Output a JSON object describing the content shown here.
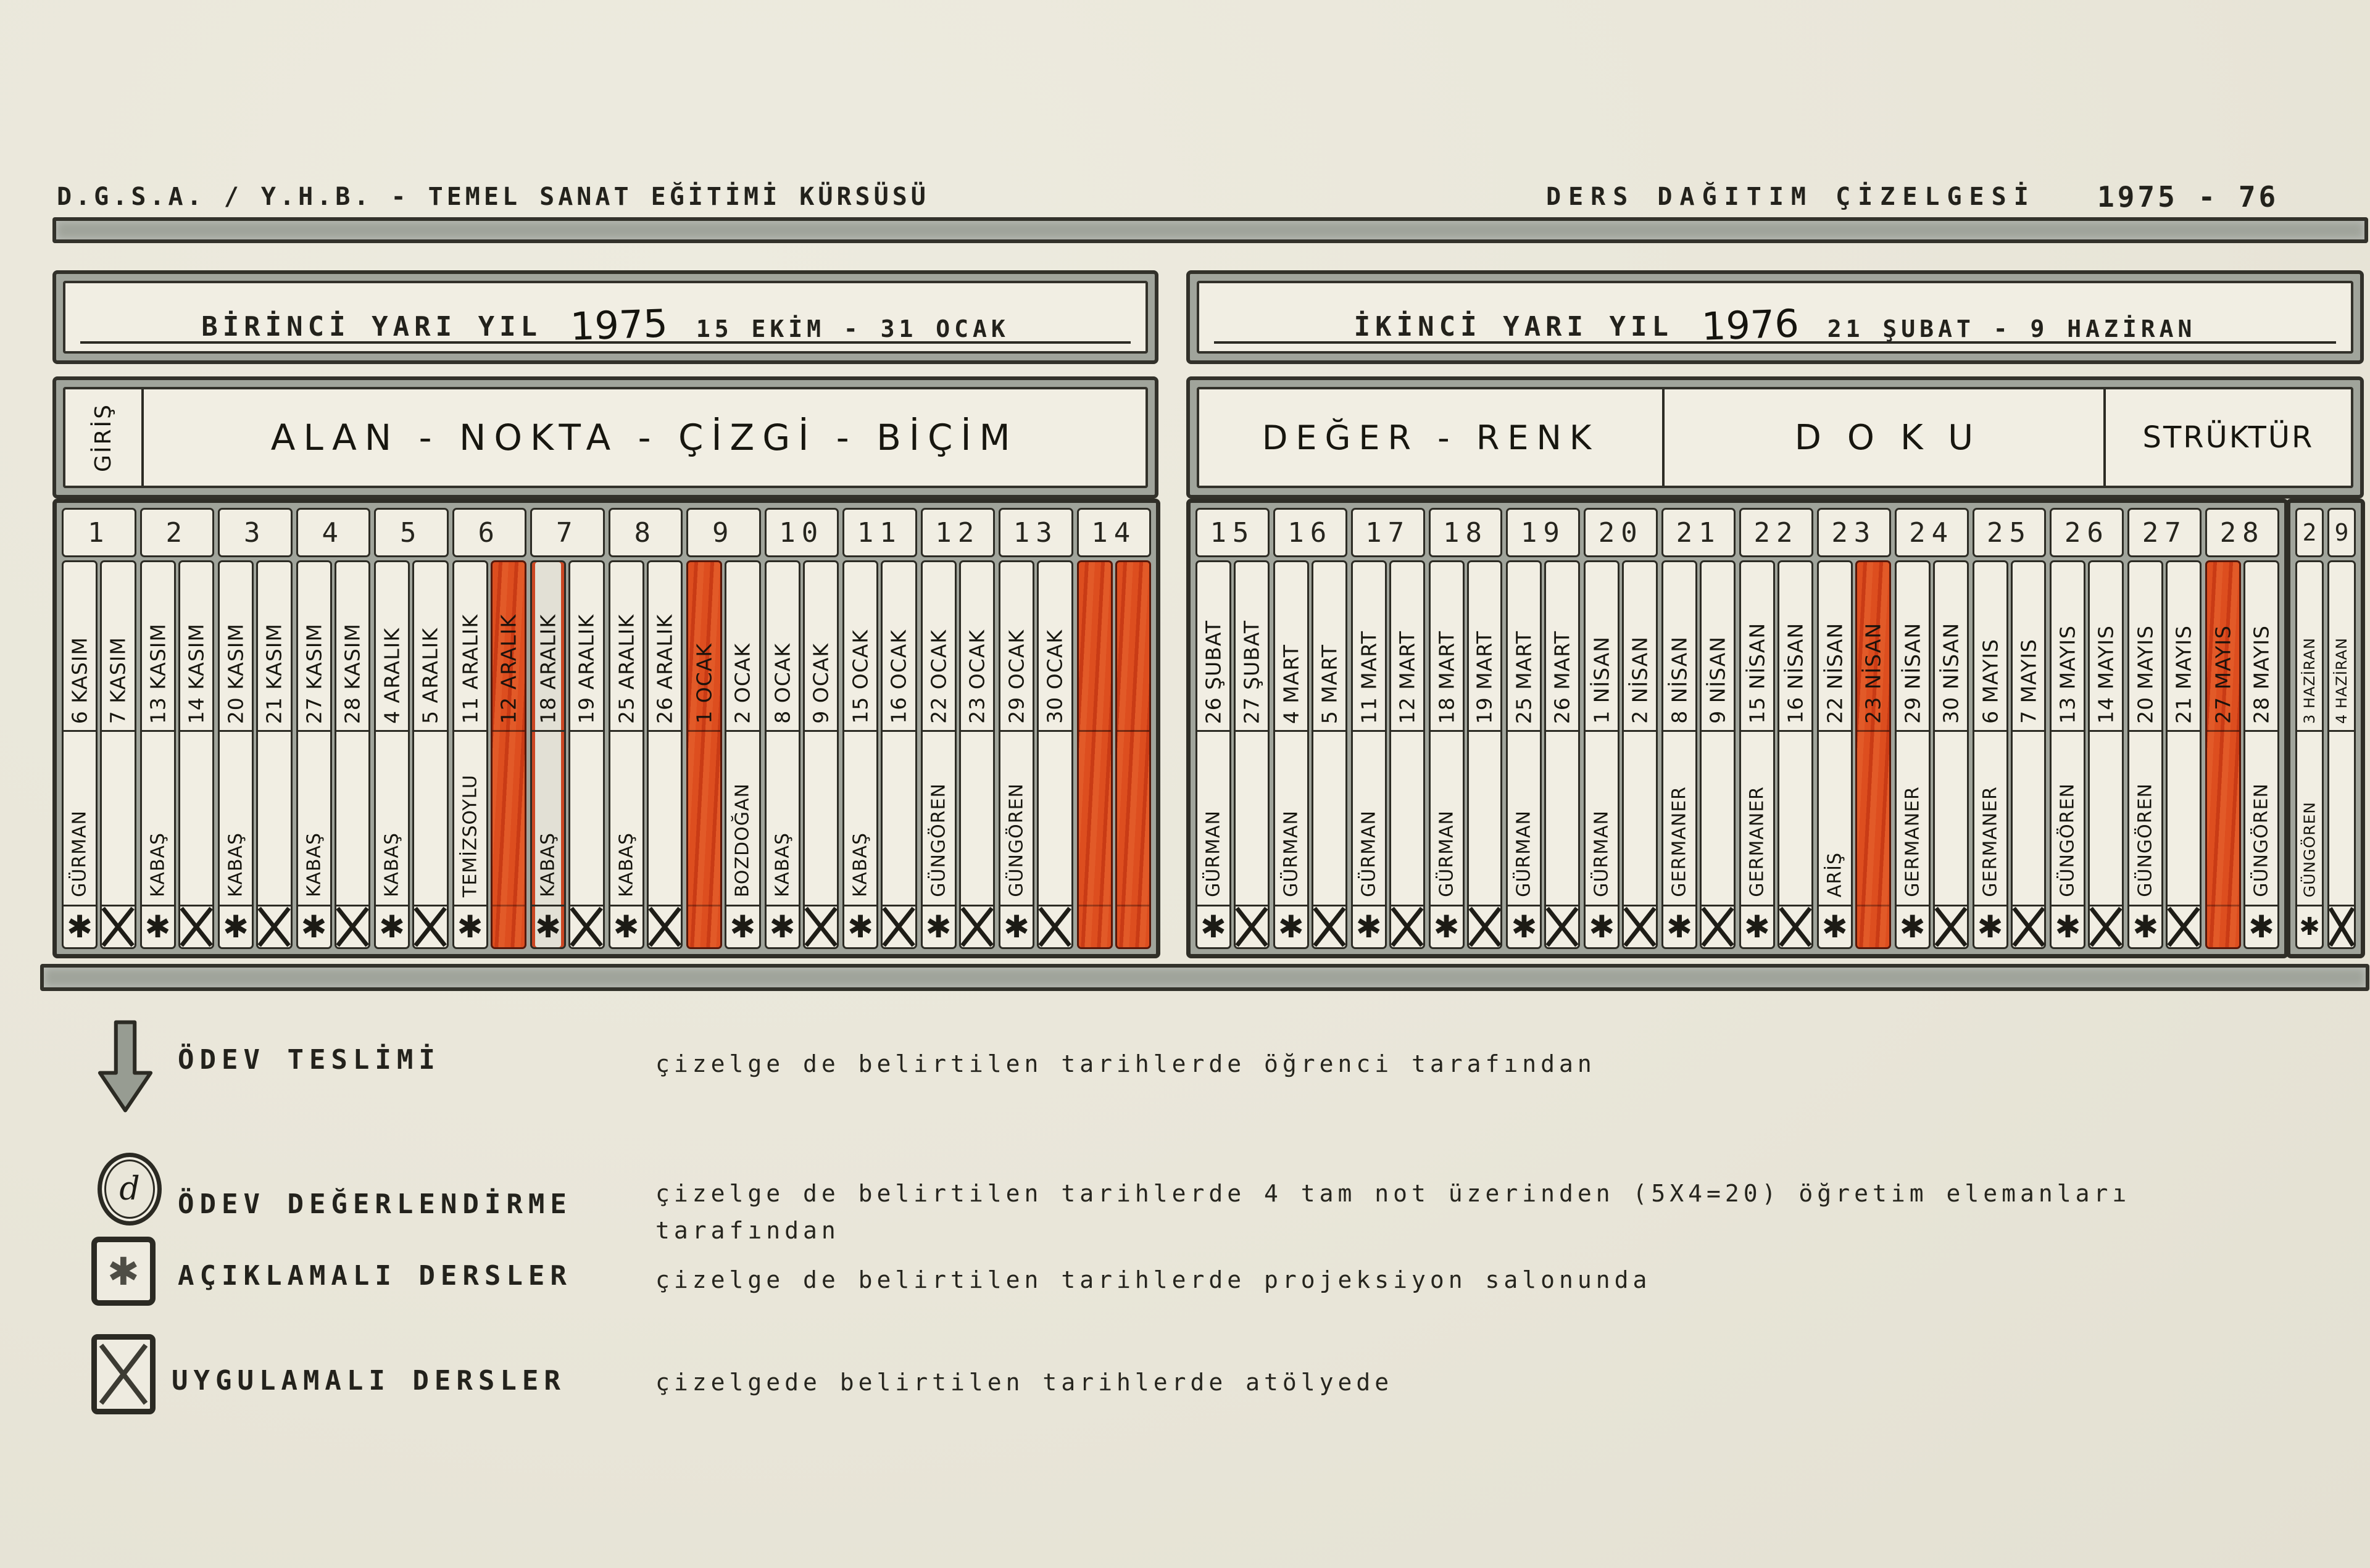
{
  "header": {
    "org": "D.G.S.A. / Y.H.B. - TEMEL SANAT EĞİTİMİ KÜRSÜSÜ",
    "doc_title": "DERS DAĞITIM ÇİZELGESİ",
    "years": "1975 - 76"
  },
  "colors": {
    "accent_red": "#d64a1d",
    "paper": "#e9e6d9",
    "bar_gray": "#a0a49b",
    "ink": "#23221c"
  },
  "semesters": [
    {
      "title": "BİRİNCİ YARI YIL",
      "year": "1975",
      "range": "15 EKİM - 31 OCAK",
      "subjects": [
        {
          "label": "GİRİŞ"
        },
        {
          "label": "ALAN - NOKTA - ÇİZGİ - BİÇİM"
        }
      ],
      "weeks": [
        {
          "num": "1",
          "days": [
            {
              "date": "6 KASIM",
              "name": "GÜRMAN",
              "sym": "star"
            },
            {
              "date": "7 KASIM",
              "sym": "x"
            }
          ]
        },
        {
          "num": "2",
          "days": [
            {
              "date": "13 KASIM",
              "name": "KABAŞ",
              "sym": "star"
            },
            {
              "date": "14 KASIM",
              "sym": "x"
            }
          ]
        },
        {
          "num": "3",
          "days": [
            {
              "date": "20 KASIM",
              "name": "KABAŞ",
              "sym": "star"
            },
            {
              "date": "21 KASIM",
              "sym": "x"
            }
          ]
        },
        {
          "num": "4",
          "days": [
            {
              "date": "27 KASIM",
              "name": "KABAŞ",
              "sym": "star"
            },
            {
              "date": "28 KASIM",
              "sym": "x"
            }
          ]
        },
        {
          "num": "5",
          "days": [
            {
              "date": "4 ARALIK",
              "name": "KABAŞ",
              "sym": "star"
            },
            {
              "date": "5 ARALIK",
              "sym": "x"
            }
          ]
        },
        {
          "num": "6",
          "days": [
            {
              "date": "11 ARALIK",
              "name": "TEMİZSOYLU",
              "sym": "star"
            },
            {
              "date": "12 ARALIK",
              "red": true
            }
          ]
        },
        {
          "num": "7",
          "days": [
            {
              "date": "18 ARALIK",
              "name": "KABAŞ",
              "sym": "star",
              "ghost": true
            },
            {
              "date": "19 ARALIK",
              "sym": "x"
            }
          ]
        },
        {
          "num": "8",
          "days": [
            {
              "date": "25 ARALIK",
              "name": "KABAŞ",
              "sym": "star"
            },
            {
              "date": "26 ARALIK",
              "sym": "x"
            }
          ]
        },
        {
          "num": "9",
          "days": [
            {
              "date": "1 OCAK",
              "red": true
            },
            {
              "date": "2 OCAK",
              "name": "BOZDOĞAN",
              "sym": "star"
            }
          ]
        },
        {
          "num": "10",
          "days": [
            {
              "date": "8 OCAK",
              "name": "KABAŞ",
              "sym": "star"
            },
            {
              "date": "9 OCAK",
              "sym": "x"
            }
          ]
        },
        {
          "num": "11",
          "days": [
            {
              "date": "15 OCAK",
              "name": "KABAŞ",
              "sym": "star"
            },
            {
              "date": "16 OCAK",
              "sym": "x"
            }
          ]
        },
        {
          "num": "12",
          "days": [
            {
              "date": "22 OCAK",
              "name": "GÜNGÖREN",
              "sym": "star"
            },
            {
              "date": "23 OCAK",
              "sym": "x"
            }
          ]
        },
        {
          "num": "13",
          "days": [
            {
              "date": "29 OCAK",
              "name": "GÜNGÖREN",
              "sym": "star"
            },
            {
              "date": "30 OCAK",
              "sym": "x"
            }
          ]
        },
        {
          "num": "14",
          "days": [
            {
              "red": true
            },
            {
              "red": true
            }
          ]
        }
      ]
    },
    {
      "title": "İKİNCİ YARI YIL",
      "year": "1976",
      "range": "21 ŞUBAT - 9 HAZİRAN",
      "subjects": [
        {
          "label": "DEĞER - RENK"
        },
        {
          "label": "DOKU"
        },
        {
          "label": "STRÜKTÜR"
        }
      ],
      "weeks": [
        {
          "num": "15",
          "days": [
            {
              "date": "26 ŞUBAT",
              "name": "GÜRMAN",
              "sym": "star"
            },
            {
              "date": "27 ŞUBAT",
              "sym": "x"
            }
          ]
        },
        {
          "num": "16",
          "days": [
            {
              "date": "4 MART",
              "name": "GÜRMAN",
              "sym": "star"
            },
            {
              "date": "5 MART",
              "sym": "x"
            }
          ]
        },
        {
          "num": "17",
          "days": [
            {
              "date": "11 MART",
              "name": "GÜRMAN",
              "sym": "star"
            },
            {
              "date": "12 MART",
              "sym": "x"
            }
          ]
        },
        {
          "num": "18",
          "days": [
            {
              "date": "18 MART",
              "name": "GÜRMAN",
              "sym": "star"
            },
            {
              "date": "19 MART",
              "sym": "x"
            }
          ]
        },
        {
          "num": "19",
          "days": [
            {
              "date": "25 MART",
              "name": "GÜRMAN",
              "sym": "star"
            },
            {
              "date": "26 MART",
              "sym": "x"
            }
          ]
        },
        {
          "num": "20",
          "days": [
            {
              "date": "1 NİSAN",
              "name": "GÜRMAN",
              "sym": "star"
            },
            {
              "date": "2 NİSAN",
              "sym": "x"
            }
          ]
        },
        {
          "num": "21",
          "days": [
            {
              "date": "8 NİSAN",
              "name": "GERMANER",
              "sym": "star"
            },
            {
              "date": "9 NİSAN",
              "sym": "x"
            }
          ]
        },
        {
          "num": "22",
          "days": [
            {
              "date": "15 NİSAN",
              "name": "GERMANER",
              "sym": "star"
            },
            {
              "date": "16 NİSAN",
              "sym": "x"
            }
          ]
        },
        {
          "num": "23",
          "days": [
            {
              "date": "22 NİSAN",
              "name": "ARİŞ",
              "sym": "star"
            },
            {
              "date": "23 NİSAN",
              "red": true
            }
          ]
        },
        {
          "num": "24",
          "days": [
            {
              "date": "29 NİSAN",
              "name": "GERMANER",
              "sym": "star"
            },
            {
              "date": "30 NİSAN",
              "sym": "x"
            }
          ]
        },
        {
          "num": "25",
          "days": [
            {
              "date": "6 MAYIS",
              "name": "GERMANER",
              "sym": "star"
            },
            {
              "date": "7 MAYIS",
              "sym": "x"
            }
          ]
        },
        {
          "num": "26",
          "days": [
            {
              "date": "13 MAYIS",
              "name": "GÜNGÖREN",
              "sym": "star"
            },
            {
              "date": "14 MAYIS",
              "sym": "x"
            }
          ]
        },
        {
          "num": "27",
          "days": [
            {
              "date": "20 MAYIS",
              "name": "GÜNGÖREN",
              "sym": "star"
            },
            {
              "date": "21 MAYIS",
              "sym": "x"
            }
          ]
        },
        {
          "num": "28",
          "days": [
            {
              "date": "27 MAYIS",
              "red": true
            },
            {
              "date": "28 MAYIS",
              "name": "GÜNGÖREN",
              "sym": "star"
            }
          ]
        }
      ],
      "extra_weeks": [
        {
          "num": "2",
          "days": [
            {
              "date": "3 HAZİRAN",
              "name": "GÜNGÖREN",
              "sym": "star"
            }
          ]
        },
        {
          "num": "9",
          "days": [
            {
              "date": "4 HAZİRAN",
              "sym": "x"
            }
          ]
        }
      ]
    }
  ],
  "legend": [
    {
      "icon": "arrow-down",
      "label": "ÖDEV TESLİMİ",
      "desc": "çizelge de belirtilen tarihlerde öğrenci tarafından"
    },
    {
      "icon": "circle-d",
      "symbol": "d",
      "label": "ÖDEV DEĞERLENDİRME",
      "desc": "çizelge de belirtilen tarihlerde 4 tam not üzerinden (5X4=20) öğretim elemanları",
      "desc2": "tarafından"
    },
    {
      "icon": "box-star",
      "symbol": "✱",
      "label": "AÇIKLAMALI DERSLER",
      "desc": "çizelge de belirtilen tarihlerde projeksiyon salonunda"
    },
    {
      "icon": "box-x",
      "label": "UYGULAMALI DERSLER",
      "desc": "çizelgede belirtilen tarihlerde atölyede"
    }
  ]
}
